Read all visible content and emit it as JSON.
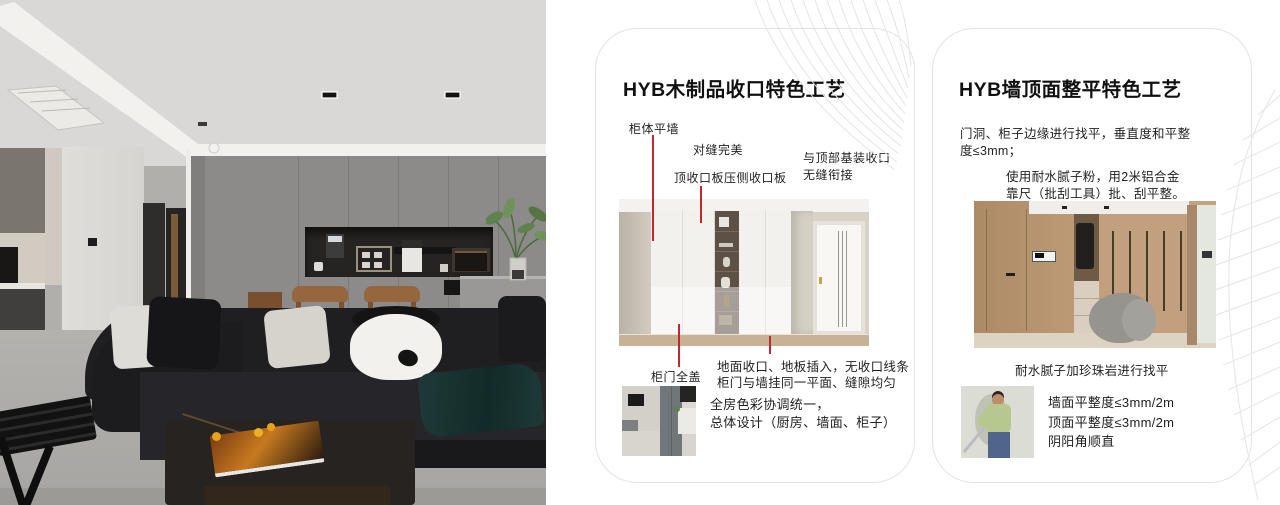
{
  "accent": {
    "annotation_red": "#c1272d"
  },
  "cards": {
    "wood": {
      "title": "HYB木制品收口特色工艺",
      "labels": {
        "cabinet_wall": "柜体平墙",
        "seam": "对缝完美",
        "top_board": "顶收口板压侧收口板",
        "top_joint_l1": "与顶部基装收口",
        "top_joint_l2": "无缝衔接",
        "door_cover": "柜门全盖",
        "floor_l1": "地面收口、地板插入，无收口线条",
        "floor_l2": "柜门与墙挂同一平面、缝隙均匀",
        "color_l1": "全房色彩协调统一，",
        "color_l2": "总体设计（厨房、墙面、柜子）"
      }
    },
    "wall": {
      "title": "HYB墙顶面整平特色工艺",
      "para1_l1": "门洞、柜子边缘进行找平，垂直度和平整",
      "para1_l2": "度≤3mm；",
      "para2_l1": "使用耐水腻子粉，用2米铝合金",
      "para2_l2": "靠尺（批刮工具）批、刮平整。",
      "caption": "耐水腻子加珍珠岩进行找平",
      "bullets": [
        "墙面平整度≤3mm/2m",
        "顶面平整度≤3mm/2m",
        "阴阳角顺直"
      ]
    }
  }
}
